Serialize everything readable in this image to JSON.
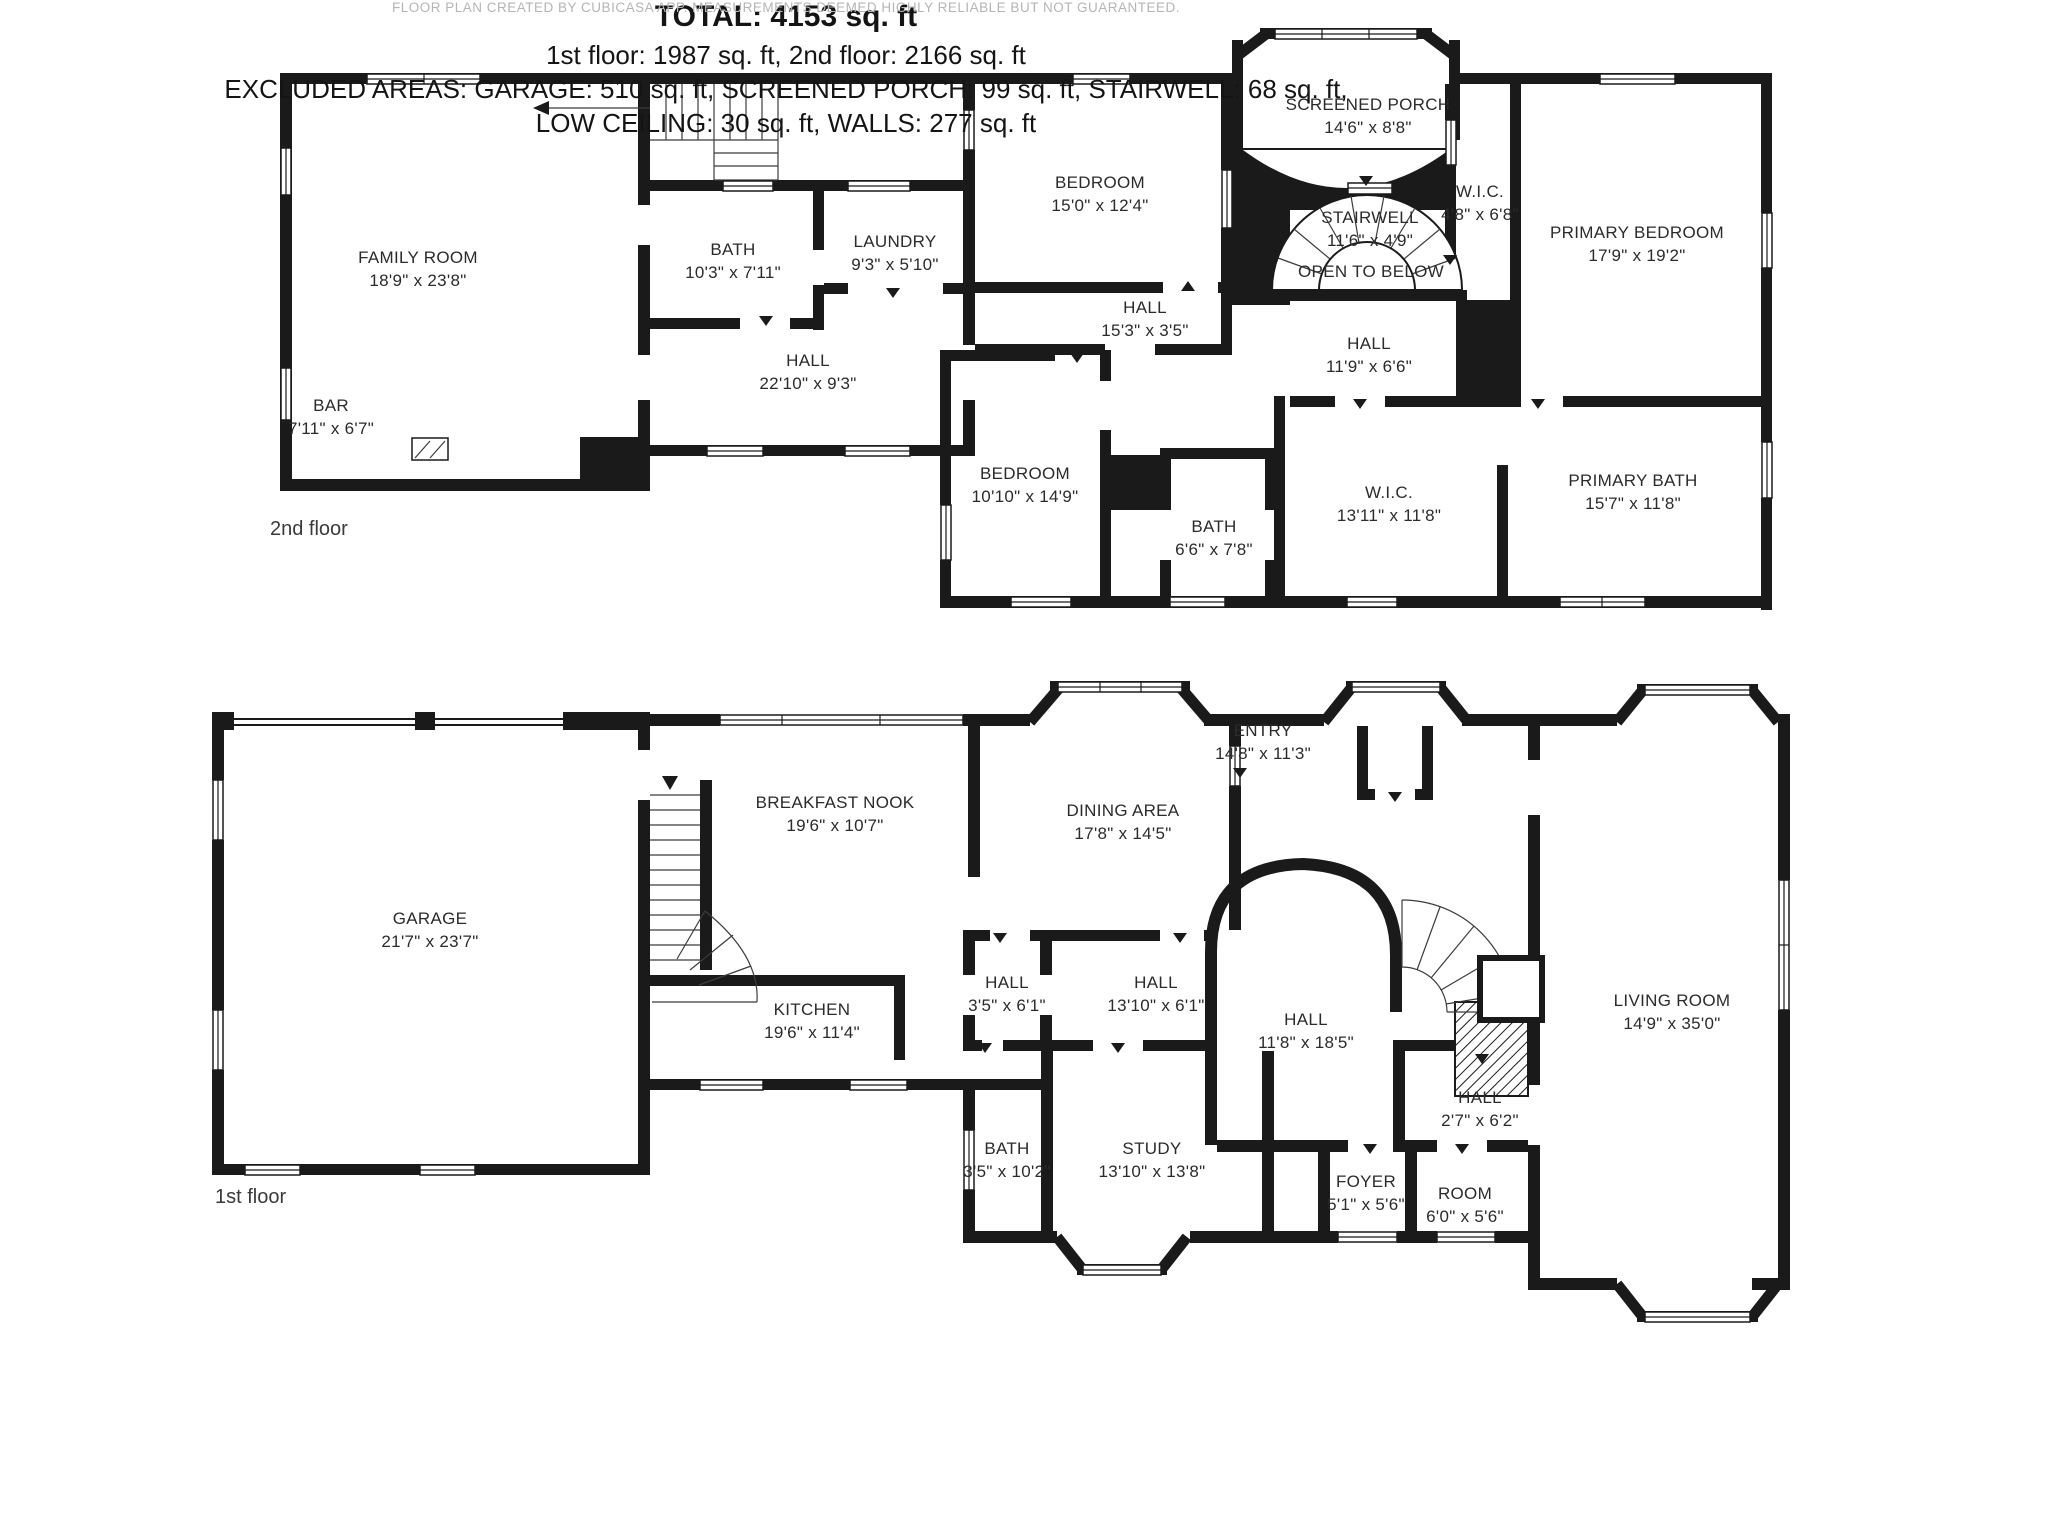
{
  "colors": {
    "wall": "#1a1a1a",
    "label_text": "#2b2b2b",
    "footer_text": "#b5b5b5",
    "background": "#ffffff"
  },
  "floors": [
    {
      "label": "2nd floor",
      "rooms": [
        {
          "name": "FAMILY ROOM",
          "dims": "18'9\" x 23'8\""
        },
        {
          "name": "BAR",
          "dims": "7'11\" x 6'7\""
        },
        {
          "name": "BATH",
          "dims": "10'3\" x 7'11\""
        },
        {
          "name": "LAUNDRY",
          "dims": "9'3\" x 5'10\""
        },
        {
          "name": "HALL",
          "dims": "22'10\" x 9'3\""
        },
        {
          "name": "BEDROOM",
          "dims": "15'0\" x 12'4\""
        },
        {
          "name": "SCREENED PORCH",
          "dims": "14'6\" x 8'8\""
        },
        {
          "name": "STAIRWELL",
          "dims": "11'6\" x 4'9\"",
          "note": "OPEN TO BELOW"
        },
        {
          "name": "W.I.C.",
          "dims": "4'8\" x 6'8\""
        },
        {
          "name": "PRIMARY BEDROOM",
          "dims": "17'9\" x 19'2\""
        },
        {
          "name": "HALL",
          "dims": "15'3\" x 3'5\""
        },
        {
          "name": "HALL",
          "dims": "11'9\" x 6'6\""
        },
        {
          "name": "BEDROOM",
          "dims": "10'10\" x 14'9\""
        },
        {
          "name": "BATH",
          "dims": "6'6\" x 7'8\""
        },
        {
          "name": "W.I.C.",
          "dims": "13'11\" x 11'8\""
        },
        {
          "name": "PRIMARY BATH",
          "dims": "15'7\" x 11'8\""
        }
      ]
    },
    {
      "label": "1st floor",
      "rooms": [
        {
          "name": "GARAGE",
          "dims": "21'7\" x 23'7\""
        },
        {
          "name": "BREAKFAST NOOK",
          "dims": "19'6\" x 10'7\""
        },
        {
          "name": "KITCHEN",
          "dims": "19'6\" x 11'4\""
        },
        {
          "name": "DINING AREA",
          "dims": "17'8\" x 14'5\""
        },
        {
          "name": "ENTRY",
          "dims": "14'8\" x 11'3\""
        },
        {
          "name": "HALL",
          "dims": "3'5\" x 6'1\""
        },
        {
          "name": "HALL",
          "dims": "13'10\" x 6'1\""
        },
        {
          "name": "HALL",
          "dims": "11'8\" x 18'5\""
        },
        {
          "name": "LIVING ROOM",
          "dims": "14'9\" x 35'0\""
        },
        {
          "name": "BATH",
          "dims": "3'5\" x 10'2\""
        },
        {
          "name": "STUDY",
          "dims": "13'10\" x 13'8\""
        },
        {
          "name": "FOYER",
          "dims": "5'1\" x 5'6\""
        },
        {
          "name": "ROOM",
          "dims": "6'0\" x 5'6\""
        },
        {
          "name": "HALL",
          "dims": "2'7\" x 6'2\""
        }
      ]
    }
  ],
  "summary": {
    "total": "TOTAL: 4153 sq. ft",
    "floors_line": "1st floor: 1987 sq. ft, 2nd floor: 2166 sq. ft",
    "excluded_line1": "EXCLUDED AREAS: GARAGE: 510 sq. ft, SCREENED PORCH: 99 sq. ft, STAIRWELL: 68 sq. ft,",
    "excluded_line2": "LOW CEILING: 30 sq. ft, WALLS: 277 sq. ft"
  },
  "footer": {
    "attribution": "FLOOR PLAN CREATED BY CUBICASA APP. MEASUREMENTS DEEMED HIGHLY RELIABLE BUT NOT GUARANTEED."
  }
}
